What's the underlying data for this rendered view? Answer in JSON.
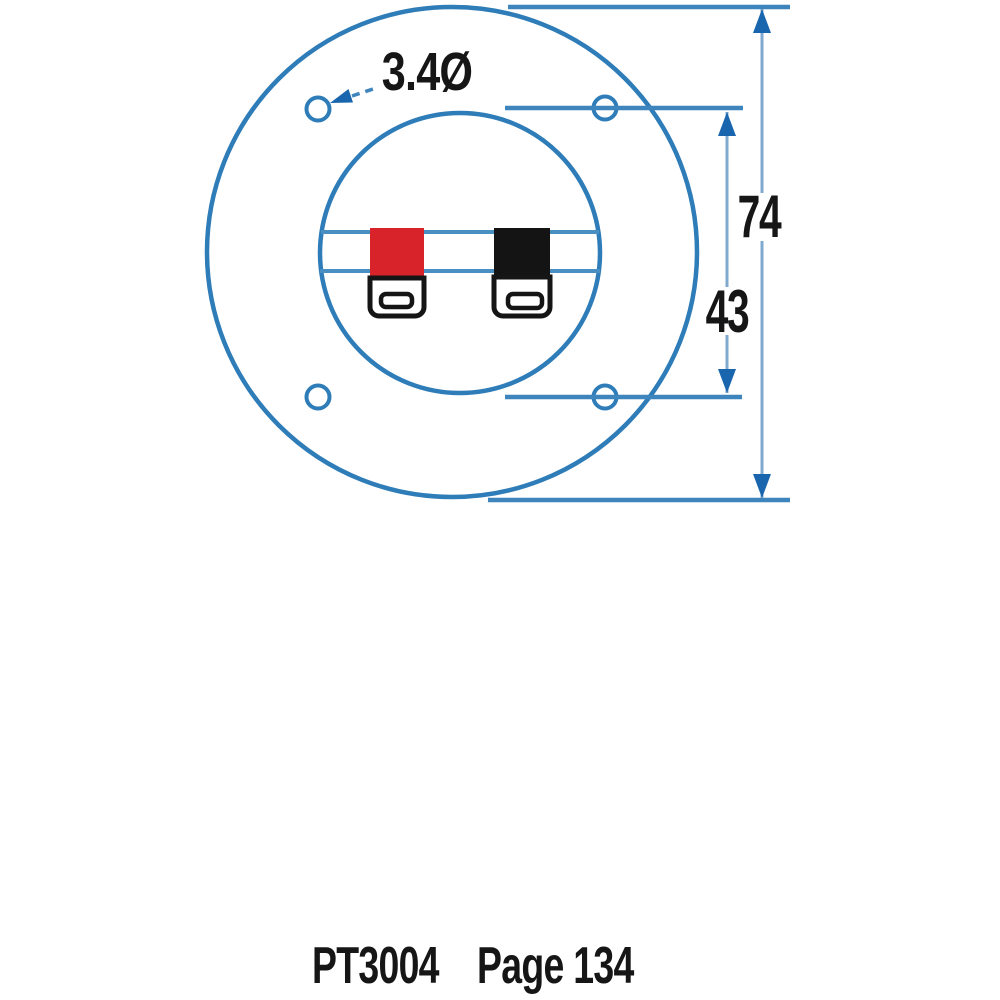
{
  "colors": {
    "line_blue": "#2e7cb8",
    "chord_blue": "#4a8fc2",
    "dim_blue": "#3f85bd",
    "shaft_blue": "#7fa9cf",
    "arrow_blue": "#1a66ae",
    "terminal_red": "#d8232a",
    "terminal_black": "#141414",
    "text_black": "#161616",
    "background": "#ffffff"
  },
  "diagram": {
    "hole_diameter_label": "3.4Ø",
    "outer_diameter_label": "74",
    "hole_spacing_label": "43"
  },
  "footer": {
    "part_number": "PT3004",
    "page_ref": "Page 134"
  }
}
